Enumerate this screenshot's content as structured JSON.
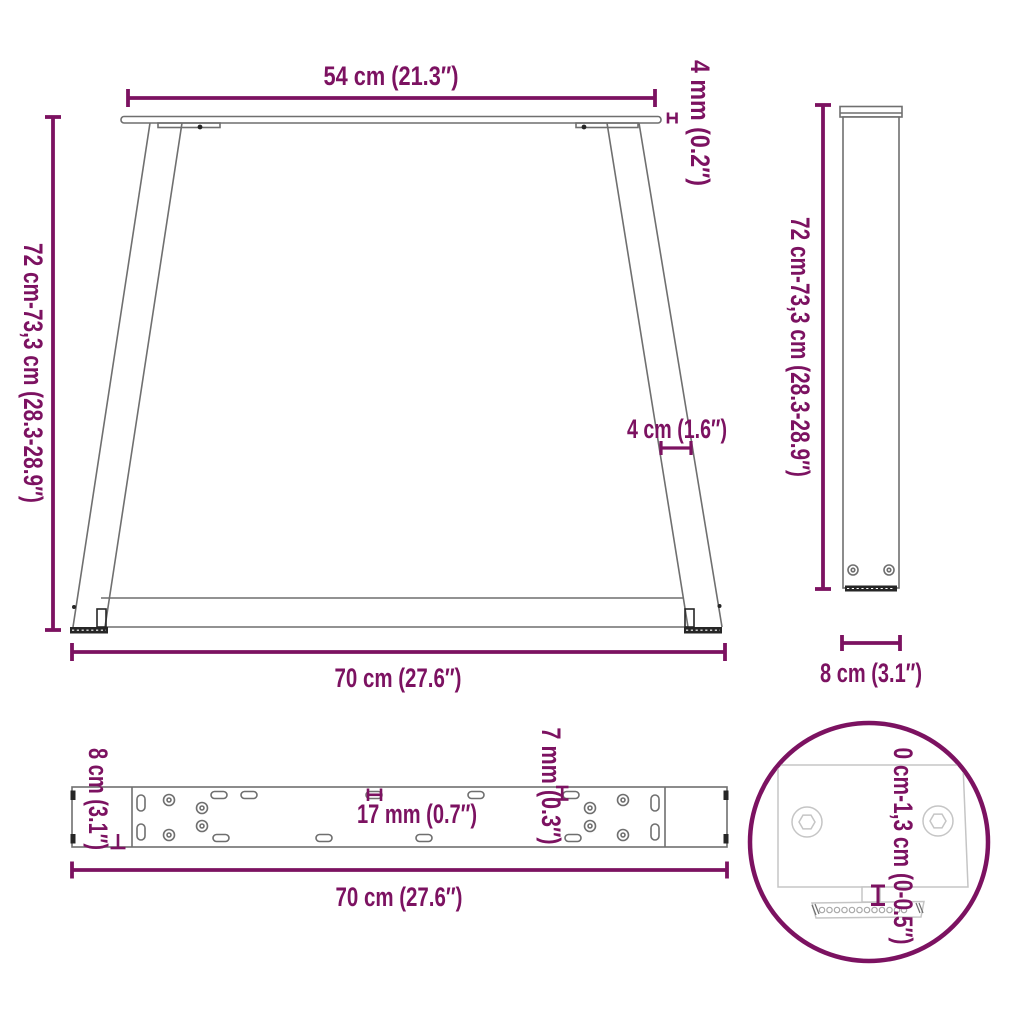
{
  "diagram": {
    "kind": "product-dimension-diagram",
    "subject": "V-shape table legs with mounting plate and adjustable foot"
  },
  "colors": {
    "accent": "#7c1261",
    "drawing": "#6f6f6f",
    "dark": "#262626",
    "light": "#c5c5c5"
  },
  "labels": {
    "front_top_width": "54 cm (21.3″)",
    "front_plate_thickness": "4 mm (0.2″)",
    "front_height": "72 cm-73,3 cm (28.3-28.9″)",
    "front_leg_width": "4 cm (1.6″)",
    "front_bottom_width": "70 cm (27.6″)",
    "side_height": "72 cm-73,3 cm (28.3-28.9″)",
    "side_depth": "8 cm (3.1″)",
    "plate_depth": "8 cm (3.1″)",
    "plate_slot_width": "17 mm (0.7″)",
    "plate_slot_height": "7 mm (0.3″)",
    "plate_length": "70 cm (27.6″)",
    "foot_adjust_range": "0 cm-1,3 cm (0-0.5″)"
  }
}
